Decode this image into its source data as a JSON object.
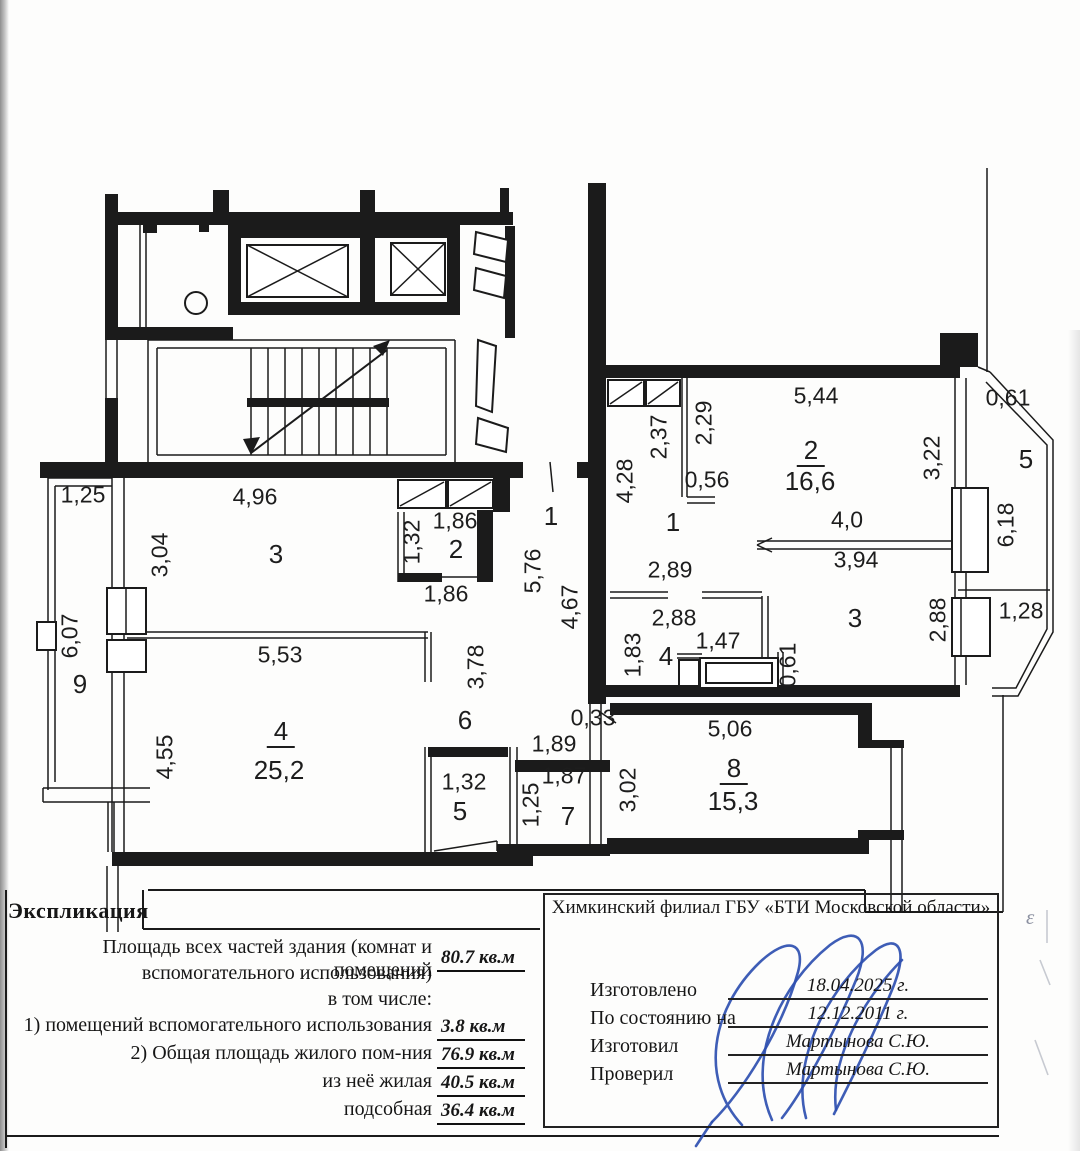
{
  "explication": {
    "title": "Экспликация",
    "line1": "Площадь всех частей здания (комнат и помещений",
    "line2": "вспомогательного использования)",
    "total": "80.7 кв.м",
    "including": "в том числе:",
    "rows": [
      {
        "label": "1) помещений вспомогательного использования",
        "value": "3.8 кв.м"
      },
      {
        "label": "2) Общая площадь жилого пом-ния",
        "value": "76.9 кв.м"
      },
      {
        "label": "из неё жилая",
        "value": "40.5 кв.м"
      },
      {
        "label": "подсобная",
        "value": "36.4 кв.м"
      }
    ]
  },
  "stamp": {
    "org": "Химкинский филиал ГБУ «БТИ Московской области»",
    "rows": [
      {
        "label": "Изготовлено",
        "value": "18.04.2025 г."
      },
      {
        "label": "По состоянию на",
        "value": "12.12.2011 г."
      },
      {
        "label": "Изготовил",
        "value": "Мартынова С.Ю."
      },
      {
        "label": "Проверил",
        "value": "Мартынова С.Ю."
      }
    ],
    "handwritten_mark": "ε"
  },
  "plan": {
    "labels": [
      {
        "t": "1,25",
        "x": 83,
        "y": 495,
        "r": 0,
        "c": "d"
      },
      {
        "t": "4,96",
        "x": 255,
        "y": 497,
        "r": 0,
        "c": "d"
      },
      {
        "t": "3,04",
        "x": 160,
        "y": 555,
        "r": 1,
        "c": "d"
      },
      {
        "t": "3",
        "x": 276,
        "y": 554,
        "r": 0,
        "c": "n"
      },
      {
        "t": "1,32",
        "x": 412,
        "y": 542,
        "r": 1,
        "c": "d"
      },
      {
        "t": "1,86",
        "x": 455,
        "y": 521,
        "r": 0,
        "c": "d"
      },
      {
        "t": "2",
        "x": 456,
        "y": 549,
        "r": 0,
        "c": "n"
      },
      {
        "t": "1,86",
        "x": 446,
        "y": 594,
        "r": 0,
        "c": "d"
      },
      {
        "t": "1",
        "x": 551,
        "y": 516,
        "r": 0,
        "c": "n"
      },
      {
        "t": "5,76",
        "x": 533,
        "y": 571,
        "r": 1,
        "c": "d"
      },
      {
        "t": "4,67",
        "x": 570,
        "y": 607,
        "r": 1,
        "c": "d"
      },
      {
        "t": "6,07",
        "x": 70,
        "y": 636,
        "r": 1,
        "c": "d"
      },
      {
        "t": "9",
        "x": 80,
        "y": 684,
        "r": 0,
        "c": "n"
      },
      {
        "t": "5,53",
        "x": 280,
        "y": 655,
        "r": 0,
        "c": "d"
      },
      {
        "t": "3,78",
        "x": 476,
        "y": 667,
        "r": 1,
        "c": "d"
      },
      {
        "t": "6",
        "x": 465,
        "y": 720,
        "r": 0,
        "c": "n"
      },
      {
        "t": "4,55",
        "x": 165,
        "y": 757,
        "r": 1,
        "c": "d"
      },
      {
        "t": "4",
        "x": 281,
        "y": 733,
        "r": 0,
        "c": "nu"
      },
      {
        "t": "25,2",
        "x": 279,
        "y": 770,
        "r": 0,
        "c": "a"
      },
      {
        "t": "1,32",
        "x": 464,
        "y": 782,
        "r": 0,
        "c": "d"
      },
      {
        "t": "5",
        "x": 460,
        "y": 811,
        "r": 0,
        "c": "n"
      },
      {
        "t": "0,33",
        "x": 593,
        "y": 718,
        "r": 0,
        "c": "d"
      },
      {
        "t": "1,89",
        "x": 554,
        "y": 744,
        "r": 0,
        "c": "d"
      },
      {
        "t": "1,87",
        "x": 564,
        "y": 776,
        "r": 0,
        "c": "d"
      },
      {
        "t": "1,25",
        "x": 531,
        "y": 805,
        "r": 1,
        "c": "d"
      },
      {
        "t": "7",
        "x": 568,
        "y": 816,
        "r": 0,
        "c": "n"
      },
      {
        "t": "3,02",
        "x": 628,
        "y": 790,
        "r": 1,
        "c": "d"
      },
      {
        "t": "4,28",
        "x": 625,
        "y": 481,
        "r": 1,
        "c": "d"
      },
      {
        "t": "2,37",
        "x": 659,
        "y": 437,
        "r": 1,
        "c": "d"
      },
      {
        "t": "2,29",
        "x": 704,
        "y": 423,
        "r": 1,
        "c": "d"
      },
      {
        "t": "5,44",
        "x": 816,
        "y": 396,
        "r": 0,
        "c": "d"
      },
      {
        "t": "0,56",
        "x": 707,
        "y": 480,
        "r": 0,
        "c": "d"
      },
      {
        "t": "2",
        "x": 811,
        "y": 452,
        "r": 0,
        "c": "nu"
      },
      {
        "t": "16,6",
        "x": 810,
        "y": 481,
        "r": 0,
        "c": "a"
      },
      {
        "t": "3,22",
        "x": 932,
        "y": 458,
        "r": 1,
        "c": "d"
      },
      {
        "t": "0,61",
        "x": 1008,
        "y": 398,
        "r": 0,
        "c": "d"
      },
      {
        "t": "5",
        "x": 1026,
        "y": 459,
        "r": 0,
        "c": "n"
      },
      {
        "t": "4,0",
        "x": 847,
        "y": 520,
        "r": 0,
        "c": "d"
      },
      {
        "t": "3,94",
        "x": 856,
        "y": 560,
        "r": 0,
        "c": "d"
      },
      {
        "t": "6,18",
        "x": 1006,
        "y": 525,
        "r": 1,
        "c": "d"
      },
      {
        "t": "1",
        "x": 673,
        "y": 522,
        "r": 0,
        "c": "n"
      },
      {
        "t": "2,89",
        "x": 670,
        "y": 570,
        "r": 0,
        "c": "d"
      },
      {
        "t": "2,88",
        "x": 674,
        "y": 618,
        "r": 0,
        "c": "d"
      },
      {
        "t": "1,47",
        "x": 718,
        "y": 641,
        "r": 0,
        "c": "d"
      },
      {
        "t": "1,83",
        "x": 633,
        "y": 655,
        "r": 1,
        "c": "d"
      },
      {
        "t": "4",
        "x": 666,
        "y": 656,
        "r": 0,
        "c": "n"
      },
      {
        "t": "0,61",
        "x": 788,
        "y": 665,
        "r": 1,
        "c": "d"
      },
      {
        "t": "3",
        "x": 855,
        "y": 618,
        "r": 0,
        "c": "n"
      },
      {
        "t": "2,88",
        "x": 938,
        "y": 620,
        "r": 1,
        "c": "d"
      },
      {
        "t": "1,28",
        "x": 1021,
        "y": 611,
        "r": 0,
        "c": "d"
      },
      {
        "t": "5,06",
        "x": 730,
        "y": 729,
        "r": 0,
        "c": "d"
      },
      {
        "t": "8",
        "x": 734,
        "y": 770,
        "r": 0,
        "c": "nu"
      },
      {
        "t": "15,3",
        "x": 733,
        "y": 801,
        "r": 0,
        "c": "a"
      }
    ]
  }
}
